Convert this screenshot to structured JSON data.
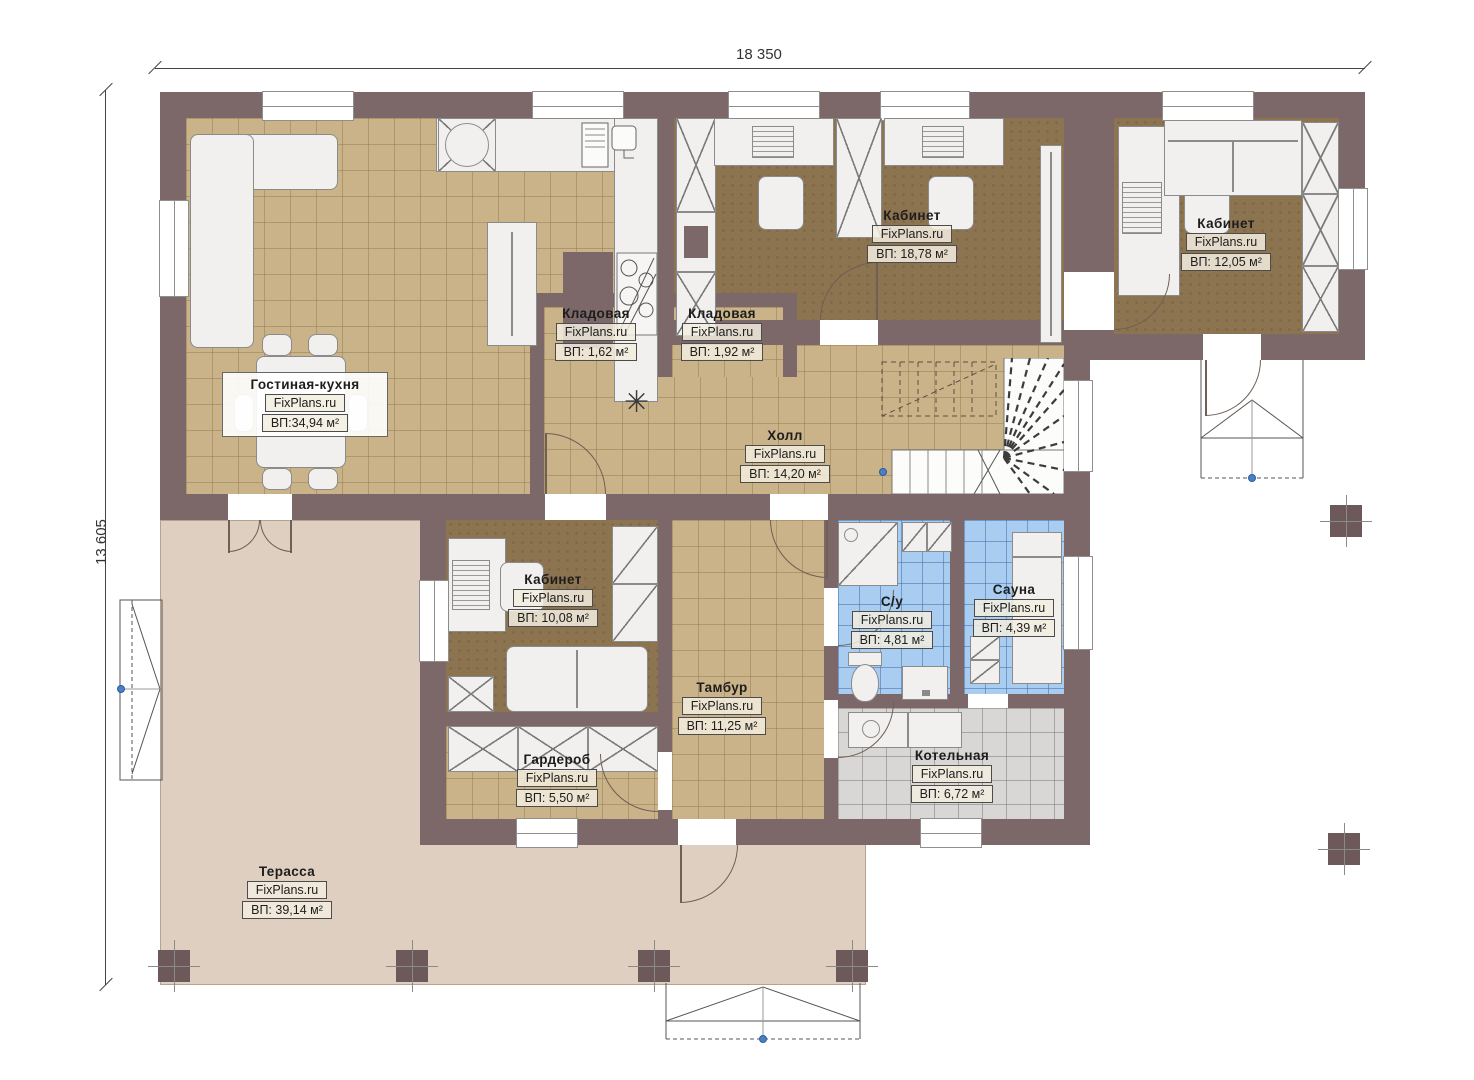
{
  "dimensions": {
    "width": "18 350",
    "height": "13 605"
  },
  "watermark": "FixPlans.ru",
  "rooms": [
    {
      "name": "Гостиная-кухня",
      "watermark": "FixPlans.ru",
      "area": "ВП:34,94 м²"
    },
    {
      "name": "Кладовая",
      "watermark": "FixPlans.ru",
      "area": "ВП: 1,62 м²"
    },
    {
      "name": "Кладовая",
      "watermark": "FixPlans.ru",
      "area": "ВП: 1,92 м²"
    },
    {
      "name": "Кабинет",
      "watermark": "FixPlans.ru",
      "area": "ВП: 18,78 м²"
    },
    {
      "name": "Кабинет",
      "watermark": "FixPlans.ru",
      "area": "ВП: 12,05 м²"
    },
    {
      "name": "Холл",
      "watermark": "FixPlans.ru",
      "area": "ВП: 14,20 м²"
    },
    {
      "name": "Кабинет",
      "watermark": "FixPlans.ru",
      "area": "ВП: 10,08 м²"
    },
    {
      "name": "С/у",
      "watermark": "FixPlans.ru",
      "area": "ВП: 4,81 м²"
    },
    {
      "name": "Сауна",
      "watermark": "FixPlans.ru",
      "area": "ВП: 4,39 м²"
    },
    {
      "name": "Тамбур",
      "watermark": "FixPlans.ru",
      "area": "ВП: 11,25 м²"
    },
    {
      "name": "Гардероб",
      "watermark": "FixPlans.ru",
      "area": "ВП: 5,50 м²"
    },
    {
      "name": "Котельная",
      "watermark": "FixPlans.ru",
      "area": "ВП: 6,72 м²"
    },
    {
      "name": "Терасса",
      "watermark": "FixPlans.ru",
      "area": "ВП: 39,14 м²"
    }
  ],
  "colors": {
    "wall": "#7c6869",
    "tile_tan": "#cab289",
    "office_brown": "#8d7450",
    "wet_room_blue": "#a9ccf1",
    "boiler_gray": "#d8d7d5",
    "terrace_beige": "#decfc0",
    "survey_point_blue": "#4a7fc4"
  }
}
